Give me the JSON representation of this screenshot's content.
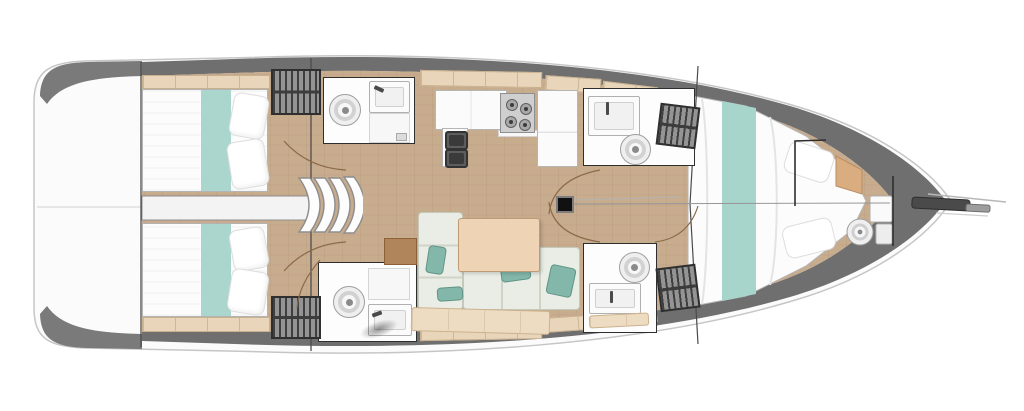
{
  "diagram": {
    "type": "boat-floor-plan",
    "subject": "Sailboat interior deck layout, top-down view, bow pointing right",
    "fixtures": {
      "transom": "stern swim platform / transom",
      "aft_cabin_port": "aft double-berth cabin (upper)",
      "aft_cabin_starboard": "aft double-berth cabin (lower)",
      "engine_compartment": "engine compartment between aft cabins",
      "companionway_steps": "companionway entry steps",
      "head_port_aft": "aft head with toilet and sink (upper)",
      "head_starboard_aft": "aft head with toilet and sink (lower)",
      "head_forward_port": "forward head with sink and toilet (upper)",
      "head_forward_starboard": "forward shower head (lower)",
      "galley": "galley with double sink, stove and fridge counter",
      "salon": "salon with L-shaped settee and table",
      "mast_post": "mast compression post",
      "forward_cabin": "forward V-berth cabin",
      "bow_head": "bow washroom with sink and toilet",
      "bowsprit": "bowsprit and anchor fitting",
      "hanging_lockers": "hanging wardrobes with hangers"
    }
  },
  "palette": {
    "hull_white": "#fbfbfb",
    "hull_stroke": "#c6c6c6",
    "deck_band": "#6f6f6f",
    "floor_tan": "#c8ac8e",
    "shelf_cream": "#e9d6ba",
    "engine_white": "#f3f3f3",
    "teal": "#a7d4cb",
    "teal_dark": "#83b7a9",
    "bed_white": "#fcfcfc",
    "fixture_outline": "#2e2e2e",
    "locker_base": "#949494",
    "locker_stripe": "#3f3f3f",
    "door_wood": "#8a6a48",
    "sofa_fill": "#eaede6",
    "sofa_line": "#c4c9bb",
    "table_wood": "#eed4b4",
    "bench_cream": "#eddcc2",
    "cabinet_brown": "#b1855c",
    "metal_dark": "#4a4a4a"
  }
}
